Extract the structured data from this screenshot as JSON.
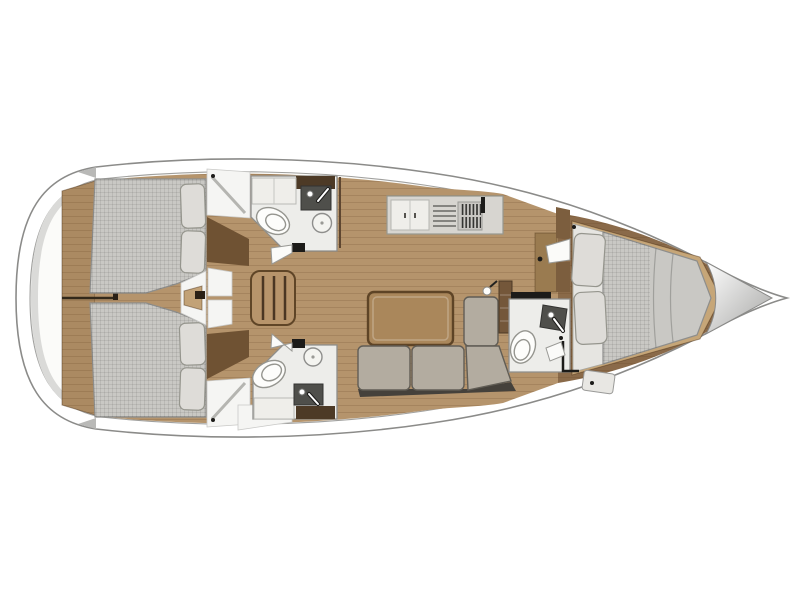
{
  "diagram": {
    "type": "sailboat-interior-floorplan",
    "orientation": "bow-right",
    "rooms": [
      "aft-cabin-port",
      "aft-cabin-starboard",
      "head-aft-port",
      "head-aft-starboard",
      "companionway",
      "galley",
      "salon",
      "head-forward",
      "forward-cabin",
      "bow-locker"
    ],
    "fixtures": [
      "double-berth",
      "double-berth",
      "v-berth",
      "toilet",
      "toilet",
      "toilet",
      "sink",
      "sink",
      "sink",
      "stove",
      "sofa",
      "table",
      "stairs"
    ]
  },
  "colors": {
    "hull_white": "#ffffff",
    "deck": "#fbfbf9",
    "stern_shade": "#dadad8",
    "floor_wood": "#b5946c",
    "floor_wood_fwd": "#8a6a49",
    "transom_wood": "#ab8a62",
    "platform_wood": "#c6a678",
    "step_wood": "#c2a277",
    "bulkhead_wood": "#7c5e3e",
    "furniture_dark_wood": "#6f5233",
    "nav_cabinet_wood": "#9a7b50",
    "table_wood": "#aa875b",
    "stair_wood": "#b7946b",
    "mattress": "#c9c8c4",
    "pillow": "#dedcd8",
    "sofa": "#b3aca0",
    "sofa_base": "#45413b",
    "counter": "#d7d5d0",
    "cabinet_white": "#efeeea",
    "stove_plate": "#c9c7c3",
    "bath_floor": "#ededea",
    "fixture_white": "#fdfdfb",
    "fixture_dark": "#4f4f4b",
    "black_accent": "#1c1b19",
    "bow_locker_light": "#fefefe",
    "bow_locker_dark": "#a6a6a4"
  }
}
